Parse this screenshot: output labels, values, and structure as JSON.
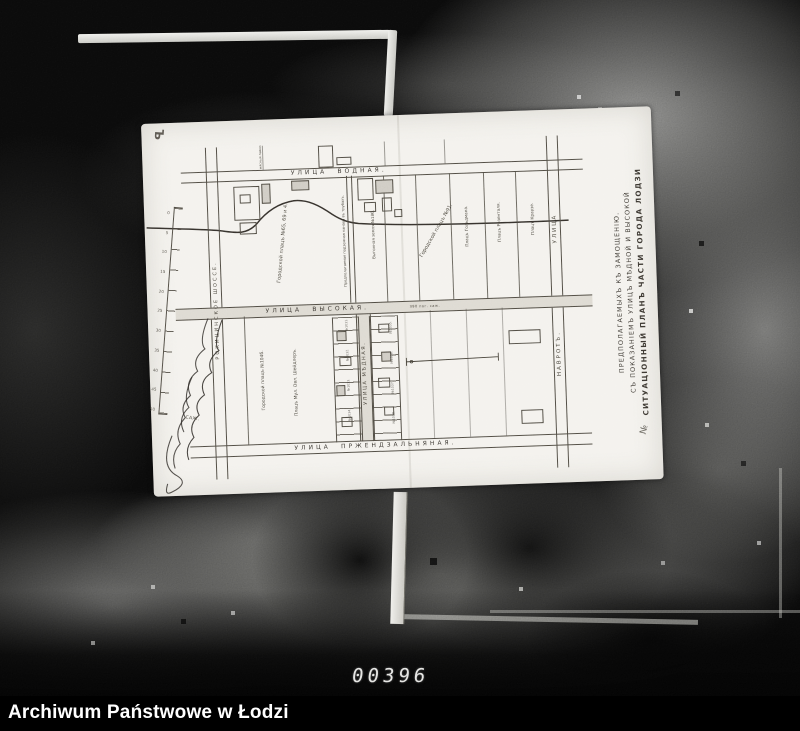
{
  "photo": {
    "frame_number": "00396",
    "caption": "Archiwum Państwowe w Łodzi"
  },
  "map": {
    "title_lines": [
      "СИТУАЦІОННЫЙ ПЛАНЪ ЧАСТИ ГОРОДА ЛОДЗИ",
      "СЪ ПОКАЗАНІЕМЪ УЛИЦЪ МѢДНОЙ И ВЫСОКОЙ",
      "ПРЕДПОЛАГАЕМЫХЪ КЪ ЗАМОЩЕНІЮ."
    ],
    "streets": {
      "vodnaya": "УЛИЦА ВОДНАЯ.",
      "vysokaya": "УЛИЦА ВЫСОКАЯ.",
      "vysokaya_note": "390 пог. саж.",
      "przendzalnyanaya": "УЛИЦА ПРЖЕНДЗАЛЬНЯНАЯ.",
      "rokicinskoe": "РОКИЦИНСКОЕ ШОССЕ.",
      "ulitsa": "УЛИЦА",
      "navrot": "НАВРОТЪ.",
      "myednaya": "УЛИЦА МѢДНАЯ."
    },
    "labels": {
      "nw_block": "Городской плацъ №65, 69 и 4.",
      "canal": "Предполагаемая подземная канава въ трубахъ.",
      "plats_91": "Городской плацъ №91.",
      "strip_186": "Выгонная земля №186.",
      "strip_a": "Плацъ Гольдмана.",
      "strip_b": "Плацъ Розенталя.",
      "strip_c": "Плацъ Краузе.",
      "shops": "мясныя лавки.",
      "sw_block": "Городской плацъ №104б.",
      "sw_block2": "Плацъ Мул. Овл. Шейдлеръ.",
      "parcel_numbers": [
        "№1031.",
        "№1032.",
        "№1033.",
        "№1034.",
        "№1035.",
        "№1036.",
        "№1037.",
        "№1038."
      ]
    },
    "scale": {
      "ticks": [
        "0",
        "5",
        "10",
        "15",
        "20",
        "25",
        "30",
        "35",
        "40",
        "45",
        "50"
      ],
      "unit": "САЖ."
    },
    "marks": {
      "top_left": "Ъ",
      "bottom_right": "№"
    }
  }
}
